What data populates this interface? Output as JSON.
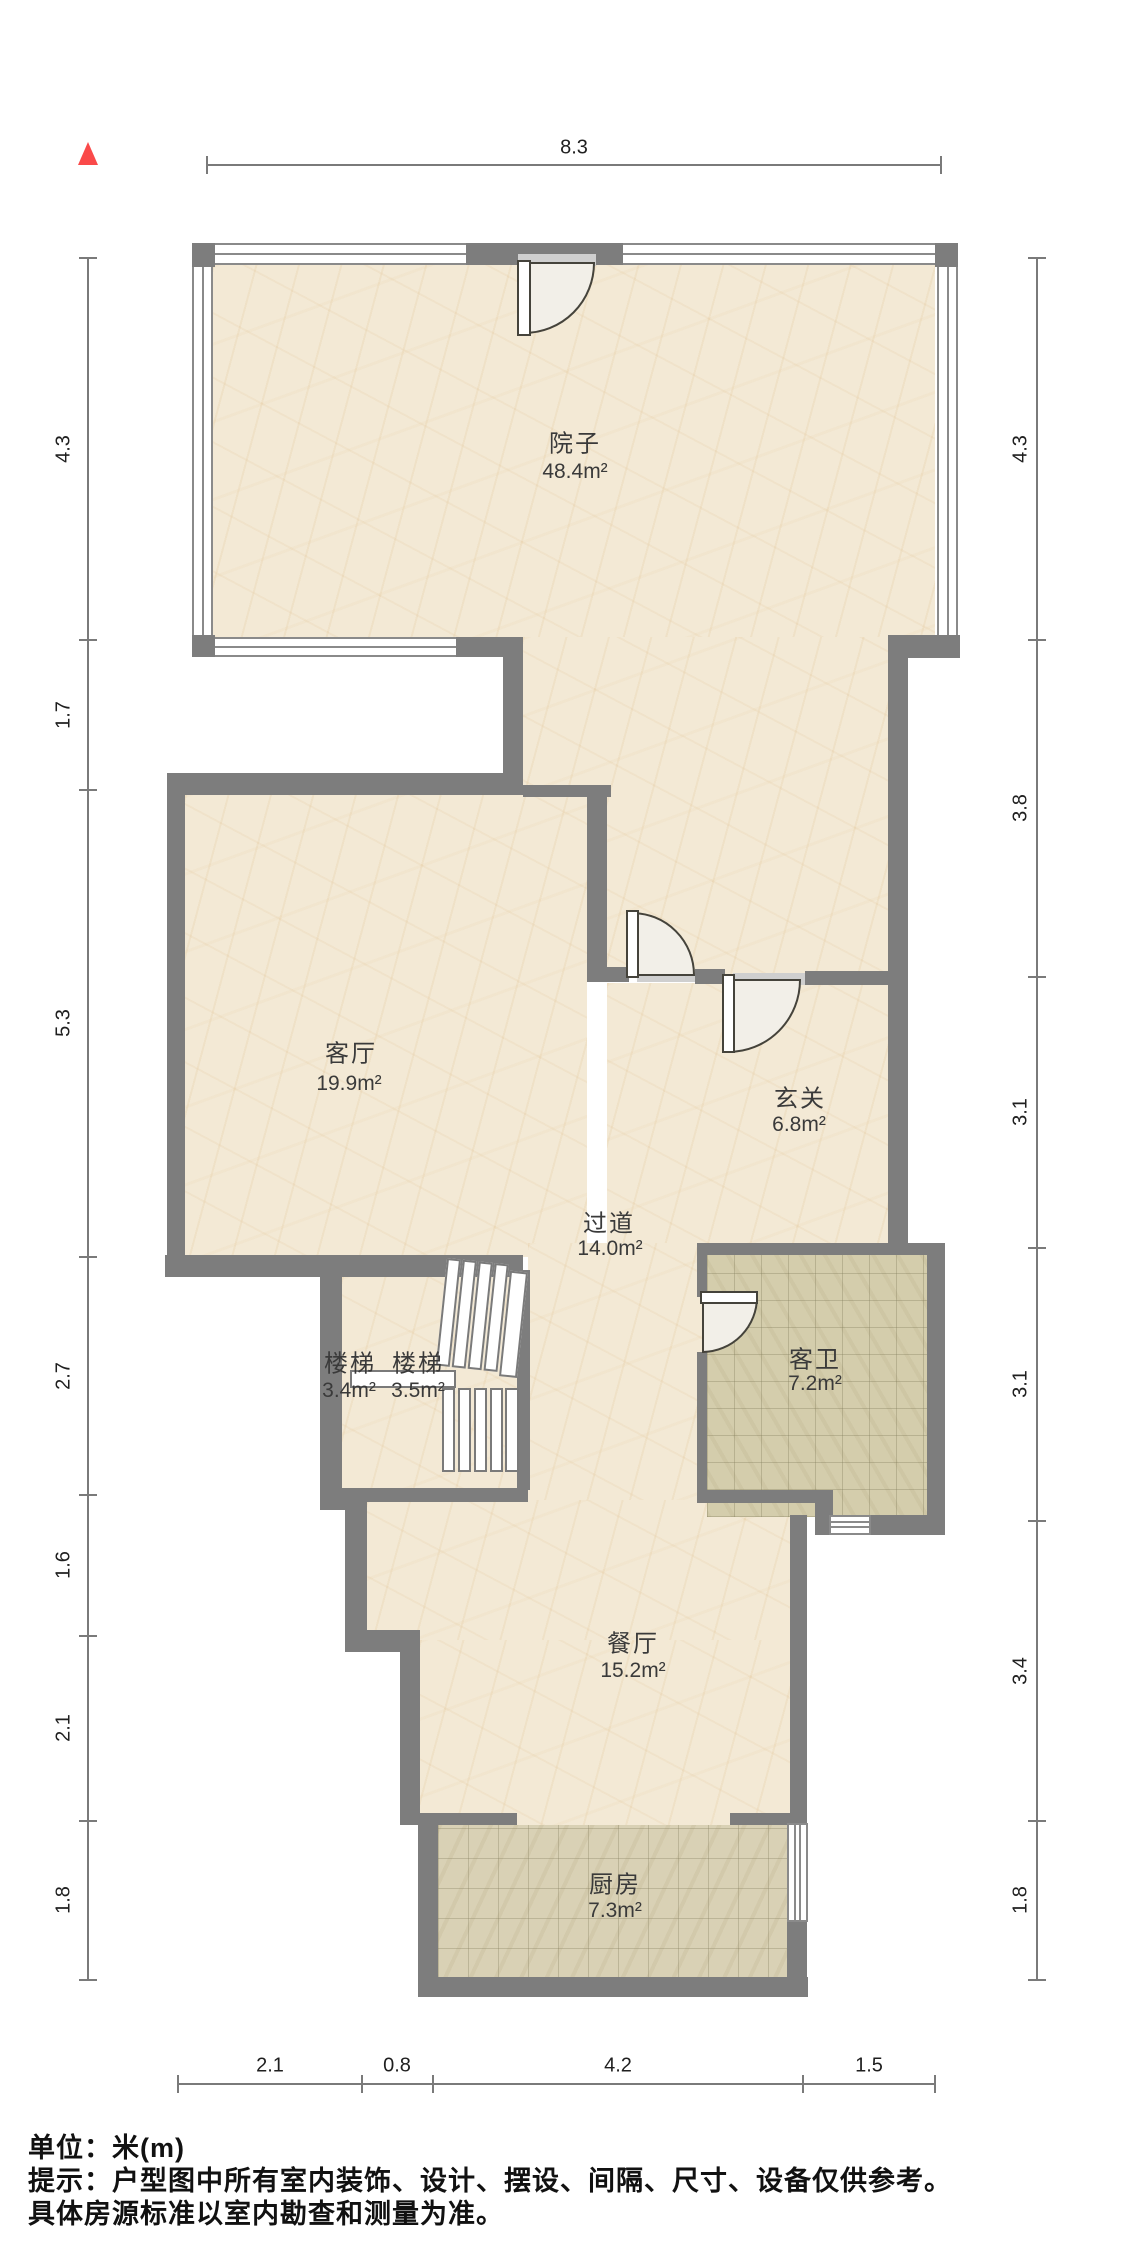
{
  "floor_plan": {
    "title": "户型图",
    "north_indicator": "north",
    "rooms": [
      {
        "name": "院子",
        "area": "48.4m²"
      },
      {
        "name": "客厅",
        "area": "19.9m²"
      },
      {
        "name": "玄关",
        "area": "6.8m²"
      },
      {
        "name": "过道",
        "area": "14.0m²"
      },
      {
        "name": "客卫",
        "area": "7.2m²"
      },
      {
        "name": "楼梯",
        "area": "3.4m²"
      },
      {
        "name": "楼梯",
        "area": "3.5m²"
      },
      {
        "name": "餐厅",
        "area": "15.2m²"
      },
      {
        "name": "厨房",
        "area": "7.3m²"
      }
    ],
    "dimensions": {
      "top": [
        "8.3"
      ],
      "left": [
        "4.3",
        "1.7",
        "5.3",
        "2.7",
        "1.6",
        "2.1",
        "1.8"
      ],
      "right": [
        "4.3",
        "3.8",
        "3.1",
        "3.1",
        "3.4",
        "1.8"
      ],
      "bottom": [
        "2.1",
        "0.8",
        "4.2",
        "1.5"
      ]
    },
    "footer": {
      "unit_line": "单位：米(m)",
      "tip_line1": "提示：户型图中所有室内装饰、设计、摆设、间隔、尺寸、设备仅供参考。",
      "tip_line2": "具体房源标准以室内勘查和测量为准。"
    },
    "colors": {
      "wall": "#7d7d7d",
      "floor": "#f3e9d5",
      "kitchen_tile": "#d9d1b5",
      "bath_tile": "#d4cdac",
      "north_arrow": "#fa4a4a"
    }
  }
}
